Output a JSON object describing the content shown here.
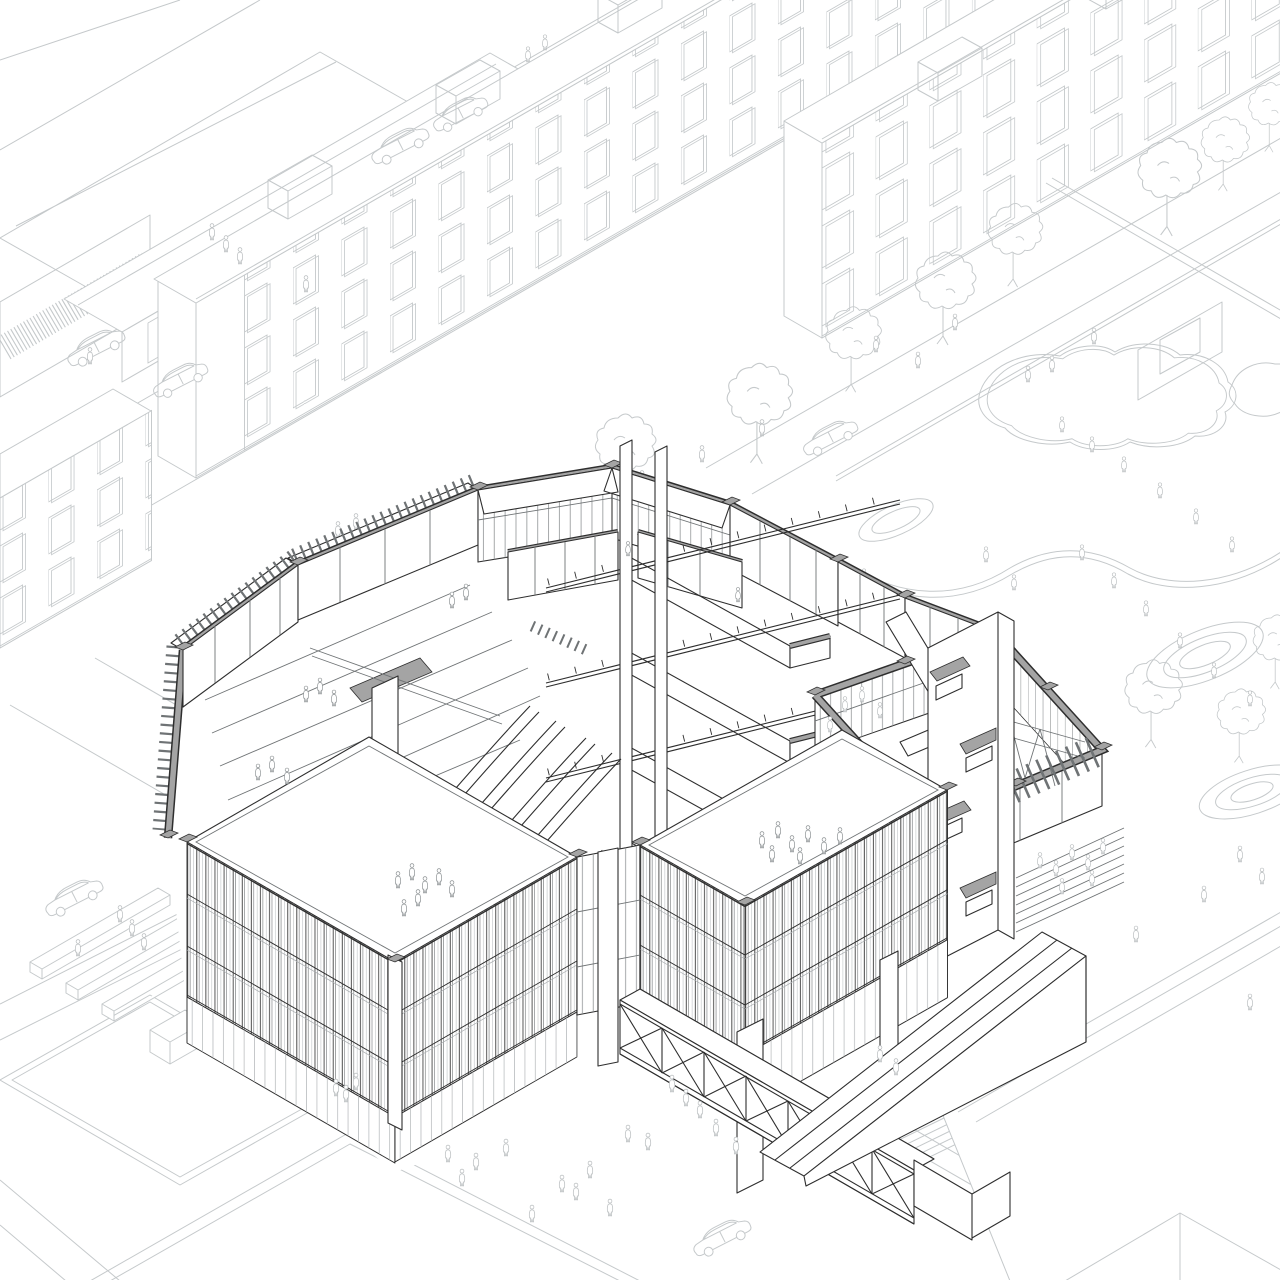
{
  "document": {
    "type": "architectural axonometric cutaway drawing",
    "description": "Isometric cutaway drawing of a faceted polygonal cultural building with a central atrium, zig-zag stairs, escalators, louvered facades, a glazed courtyard wing, a pedestrian truss bridge and a grandstand ramp, surrounded by pale line-drawn urban context: shop rows, apartment slabs with punched windows, streets with cars, pedestrians, street trees and a landscaped park with ponds and contoured mounds",
    "technique": "black ink linework on white; sectioned walls capped with grey poche; context drawn in light grey"
  },
  "colors": {
    "background": "#ffffff",
    "context_line": "#c5c9cb",
    "context_line_soft": "#d4d7d9",
    "ink": "#2e2e2e",
    "mid_line": "#707476",
    "light_line": "#a9adb0",
    "poche_fill": "#a4a4a4",
    "poche_dark": "#8f8f8f",
    "fin_dash": "#6f7375",
    "figure_context": "#b9bdbf",
    "figure_building": "#8f9496"
  },
  "scene": {
    "context": [
      "shop row with slatted wall",
      "north apartment slab",
      "north-east apartment slab",
      "west apartment slab",
      "streets with cars",
      "pedestrians",
      "street trees",
      "park with two ponds",
      "contoured landscape mounds",
      "planters",
      "south rooftops"
    ],
    "building": [
      "perimeter cut walls with louver crowns",
      "amphitheatre terraces",
      "atrium stair core with four flights",
      "escalator bank",
      "glazed courtyard wing with roof truss",
      "switchback stair tower",
      "south-west louver pavilion",
      "south louver pavilion on pilotis",
      "recessed glazed bay",
      "roof terraces with visitors",
      "pedestrian truss bridge",
      "grandstand ramp"
    ]
  }
}
